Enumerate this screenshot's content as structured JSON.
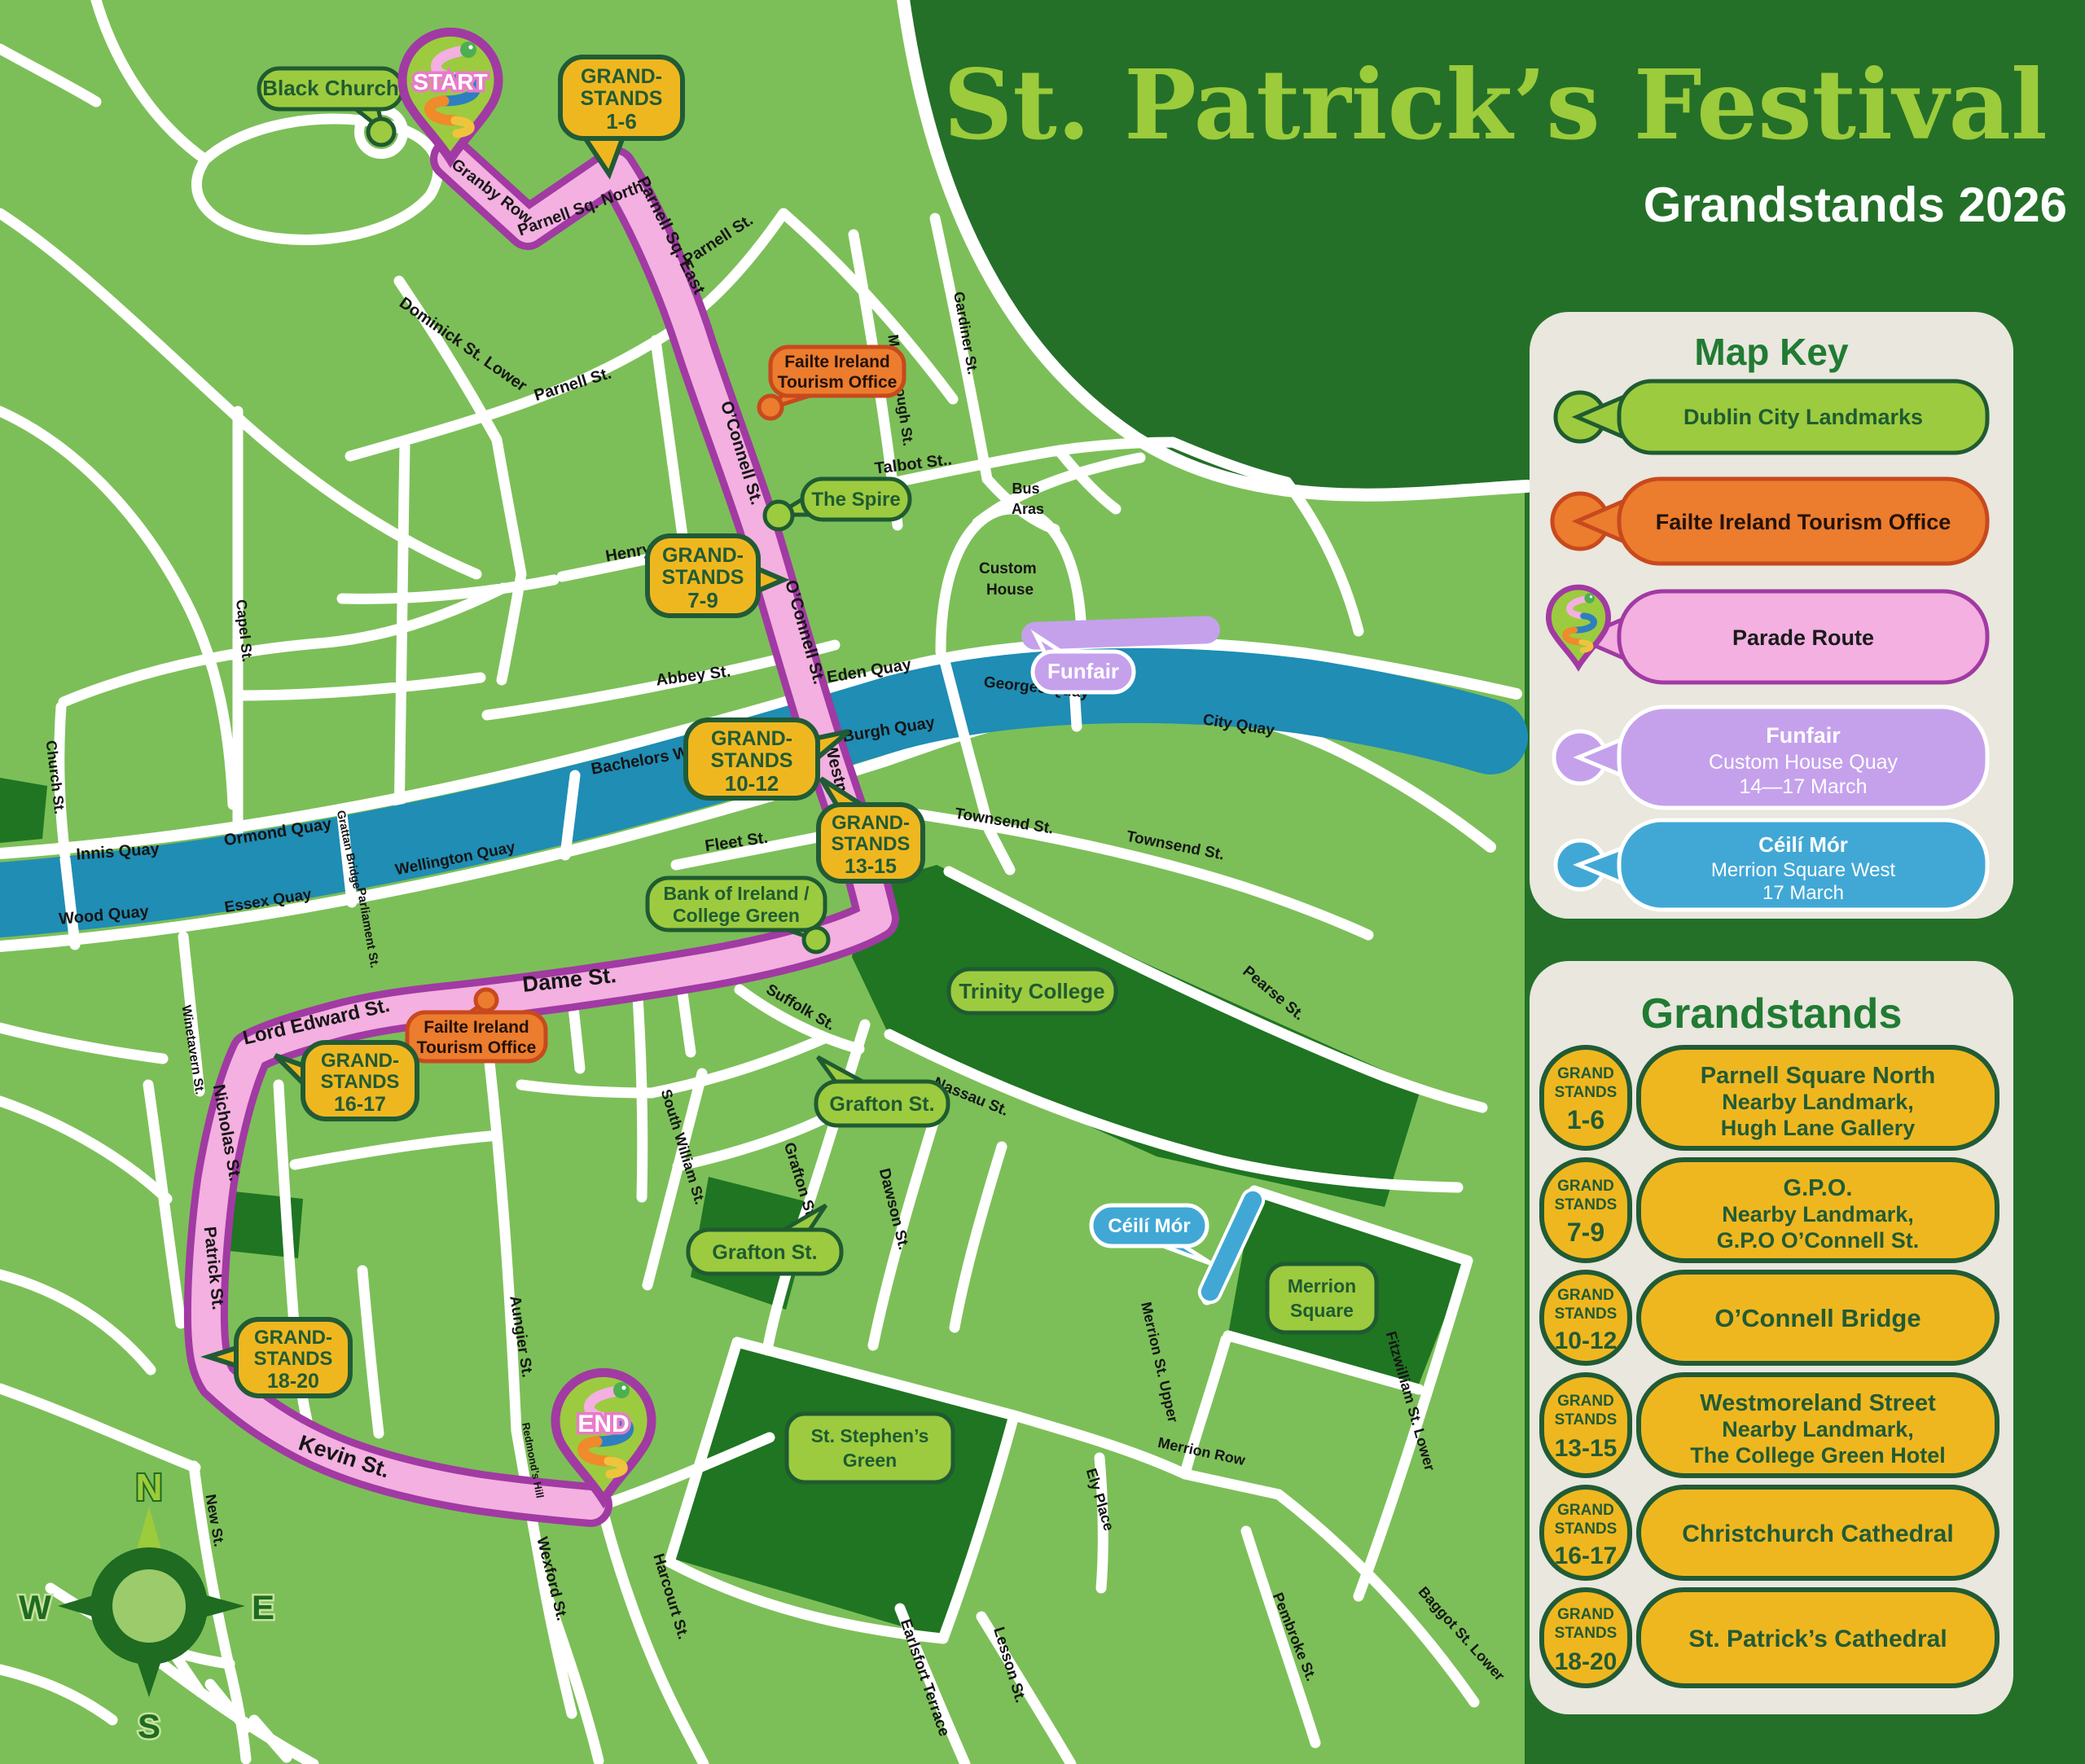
{
  "title": {
    "main": "St. Patrick’s Festival",
    "subtitle": "Grandstands 2026"
  },
  "map_key": {
    "title": "Map Key",
    "items": [
      {
        "label": "Dublin City Landmarks"
      },
      {
        "label": "Failte Ireland Tourism Office"
      },
      {
        "label": "Parade Route"
      },
      {
        "title": "Funfair",
        "line2": "Custom House Quay",
        "line3": "14—17 March"
      },
      {
        "title": "Céilí Mór",
        "line2": "Merrion Square West",
        "line3": "17 March"
      }
    ]
  },
  "grandstands": {
    "title": "Grandstands",
    "badge_word1": "GRAND",
    "badge_word2": "STANDS",
    "items": [
      {
        "range": "1-6",
        "name": "Parnell Square North",
        "line2": "Nearby Landmark,",
        "line3": "Hugh Lane Gallery"
      },
      {
        "range": "7-9",
        "name": "G.P.O.",
        "line2": "Nearby Landmark,",
        "line3": "G.P.O O’Connell St."
      },
      {
        "range": "10-12",
        "name": "O’Connell Bridge"
      },
      {
        "range": "13-15",
        "name": "Westmoreland Street",
        "line2": "Nearby Landmark,",
        "line3": "The College Green Hotel"
      },
      {
        "range": "16-17",
        "name": "Christchurch Cathedral"
      },
      {
        "range": "18-20",
        "name": "St. Patrick’s Cathedral"
      }
    ]
  },
  "map": {
    "markers": {
      "start": "START",
      "end": "END"
    },
    "callouts": {
      "black_church": "Black Church",
      "spire": "The Spire",
      "bank_l1": "Bank of Ireland /",
      "bank_l2": "College Green",
      "trinity": "Trinity College",
      "grafton": "Grafton St.",
      "merrion_l1": "Merrion",
      "merrion_l2": "Square",
      "stephens_l1": "St. Stephen’s",
      "stephens_l2": "Green",
      "failte_l1": "Failte Ireland",
      "failte_l2": "Tourism Office",
      "funfair": "Funfair",
      "ceili": "Céilí Mór",
      "custom_house_l1": "Custom",
      "custom_house_l2": "House",
      "bus_aras_l1": "Bus",
      "bus_aras_l2": "Aras",
      "gs": [
        {
          "l1": "GRAND-",
          "l2": "STANDS",
          "l3": "1-6"
        },
        {
          "l1": "GRAND-",
          "l2": "STANDS",
          "l3": "7-9"
        },
        {
          "l1": "GRAND-",
          "l2": "STANDS",
          "l3": "10-12"
        },
        {
          "l1": "GRAND-",
          "l2": "STANDS",
          "l3": "13-15"
        },
        {
          "l1": "GRAND-",
          "l2": "STANDS",
          "l3": "16-17"
        },
        {
          "l1": "GRAND-",
          "l2": "STANDS",
          "l3": "18-20"
        }
      ]
    },
    "street_labels": [
      {
        "text": "Granby Row"
      },
      {
        "text": "Parnell Sq. North"
      },
      {
        "text": "Parnell Sq. East"
      },
      {
        "text": "Dominick St. Lower"
      },
      {
        "text": "Parnell St."
      },
      {
        "text": "Parnell St."
      },
      {
        "text": "O’Connell St."
      },
      {
        "text": "O’Connell St."
      },
      {
        "text": "Marlborough St."
      },
      {
        "text": "Gardiner St."
      },
      {
        "text": "Talbot St.."
      },
      {
        "text": "Henry St."
      },
      {
        "text": "Abbey St."
      },
      {
        "text": "Eden Quay"
      },
      {
        "text": "Burgh Quay"
      },
      {
        "text": "Bachelors Walk"
      },
      {
        "text": "Georges Quay"
      },
      {
        "text": "City Quay"
      },
      {
        "text": "Townsend St."
      },
      {
        "text": "Townsend St."
      },
      {
        "text": "Fleet St."
      },
      {
        "text": "Pearse St."
      },
      {
        "text": "Innis Quay"
      },
      {
        "text": "Ormond Quay"
      },
      {
        "text": "Wellington Quay"
      },
      {
        "text": "Essex Quay"
      },
      {
        "text": "Wood Quay"
      },
      {
        "text": "Church St."
      },
      {
        "text": "Capel St."
      },
      {
        "text": "Grattan Bridge"
      },
      {
        "text": "Parliament St."
      },
      {
        "text": "Lord Edward St."
      },
      {
        "text": "Dame St."
      },
      {
        "text": "Winetavern St."
      },
      {
        "text": "Nicholas St."
      },
      {
        "text": "Patrick St."
      },
      {
        "text": "Kevin St."
      },
      {
        "text": "New St."
      },
      {
        "text": "Suffolk St."
      },
      {
        "text": "Nassau St."
      },
      {
        "text": "Grafton St."
      },
      {
        "text": "South William St."
      },
      {
        "text": "Dawson St."
      },
      {
        "text": "Aungier St."
      },
      {
        "text": "Redmond’s Hill"
      },
      {
        "text": "Wexford St."
      },
      {
        "text": "Harcourt St."
      },
      {
        "text": "Earlsfort Terrace"
      },
      {
        "text": "Lesson St."
      },
      {
        "text": "Merrion St. Upper"
      },
      {
        "text": "Merrion Row"
      },
      {
        "text": "Ely Place"
      },
      {
        "text": "Fitzwilliam St. Lower"
      },
      {
        "text": "Pembroke St."
      },
      {
        "text": "Baggot St. Lower"
      },
      {
        "text": "Westmoreland St."
      }
    ]
  },
  "compass": {
    "n": "N",
    "e": "E",
    "s": "S",
    "w": "W"
  }
}
